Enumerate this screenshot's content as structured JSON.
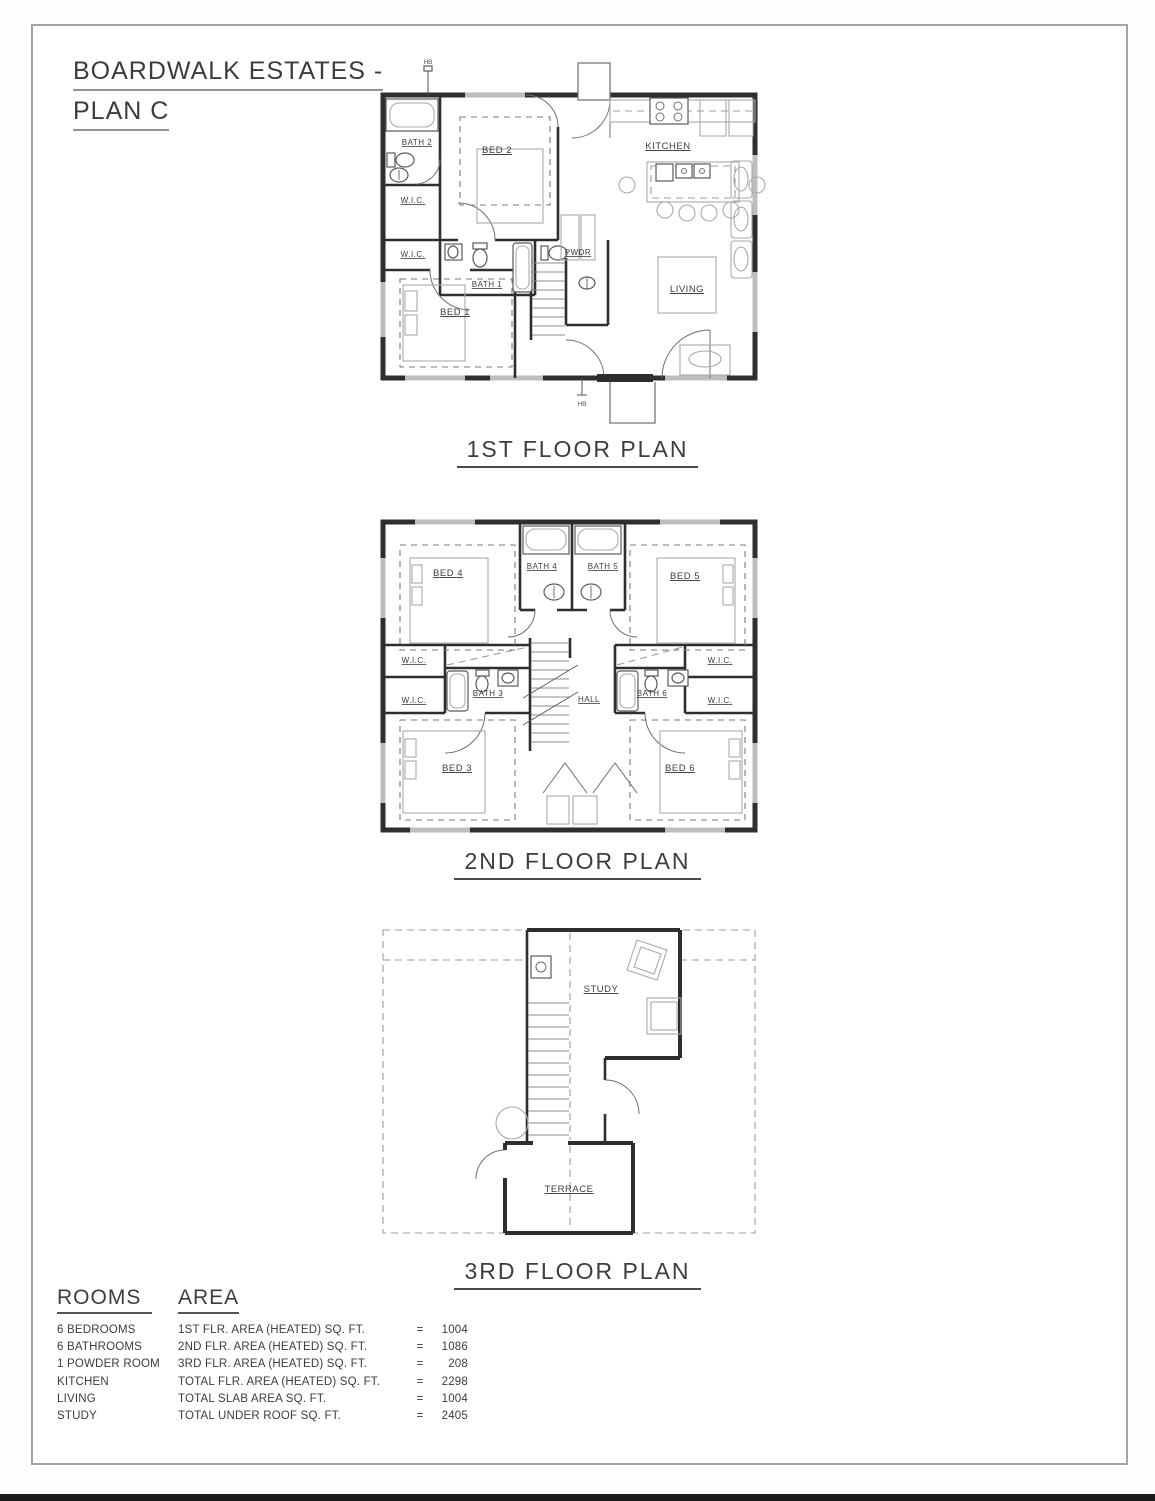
{
  "title": {
    "line1": "BOARDWALK ESTATES -",
    "line2": "PLAN C"
  },
  "floor1": {
    "caption": "1ST FLOOR PLAN",
    "rooms": {
      "bath2": "BATH 2",
      "bed2": "BED 2",
      "kitchen": "KITCHEN",
      "wic_a": "W.I.C.",
      "wic_b": "W.I.C.",
      "bath1": "BATH 1",
      "pwdr": "PWDR",
      "bed1": "BED 1",
      "living": "LIVING"
    },
    "marks": {
      "hb_top": "HB",
      "hb_bottom": "HB"
    }
  },
  "floor2": {
    "caption": "2ND FLOOR PLAN",
    "rooms": {
      "bed4": "BED 4",
      "bath4": "BATH 4",
      "bath5": "BATH 5",
      "bed5": "BED 5",
      "wic_lt": "W.I.C.",
      "wic_lb": "W.I.C.",
      "wic_rt": "W.I.C.",
      "wic_rb": "W.I.C.",
      "bath3": "BATH 3",
      "hall": "HALL",
      "bath6": "BATH 6",
      "bed3": "BED 3",
      "bed6": "BED 6"
    }
  },
  "floor3": {
    "caption": "3RD FLOOR PLAN",
    "rooms": {
      "study": "STUDY",
      "terrace": "TERRACE"
    }
  },
  "summary": {
    "rooms_header": "ROOMS",
    "area_header": "AREA",
    "rooms": [
      "6 BEDROOMS",
      "6 BATHROOMS",
      "1 POWDER ROOM",
      "KITCHEN",
      "LIVING",
      "STUDY"
    ],
    "areas": [
      {
        "label": "1ST FLR. AREA (HEATED) SQ. FT.",
        "eq": "=",
        "value": "1004"
      },
      {
        "label": "2ND FLR. AREA (HEATED) SQ. FT.",
        "eq": "=",
        "value": "1086"
      },
      {
        "label": "3RD FLR. AREA (HEATED) SQ. FT.",
        "eq": "=",
        "value": "208"
      },
      {
        "label": "TOTAL FLR. AREA (HEATED) SQ. FT.",
        "eq": "=",
        "value": "2298"
      },
      {
        "label": "TOTAL SLAB AREA SQ. FT.",
        "eq": "=",
        "value": "1004"
      },
      {
        "label": "TOTAL UNDER ROOF SQ. FT.",
        "eq": "=",
        "value": "2405"
      }
    ]
  }
}
